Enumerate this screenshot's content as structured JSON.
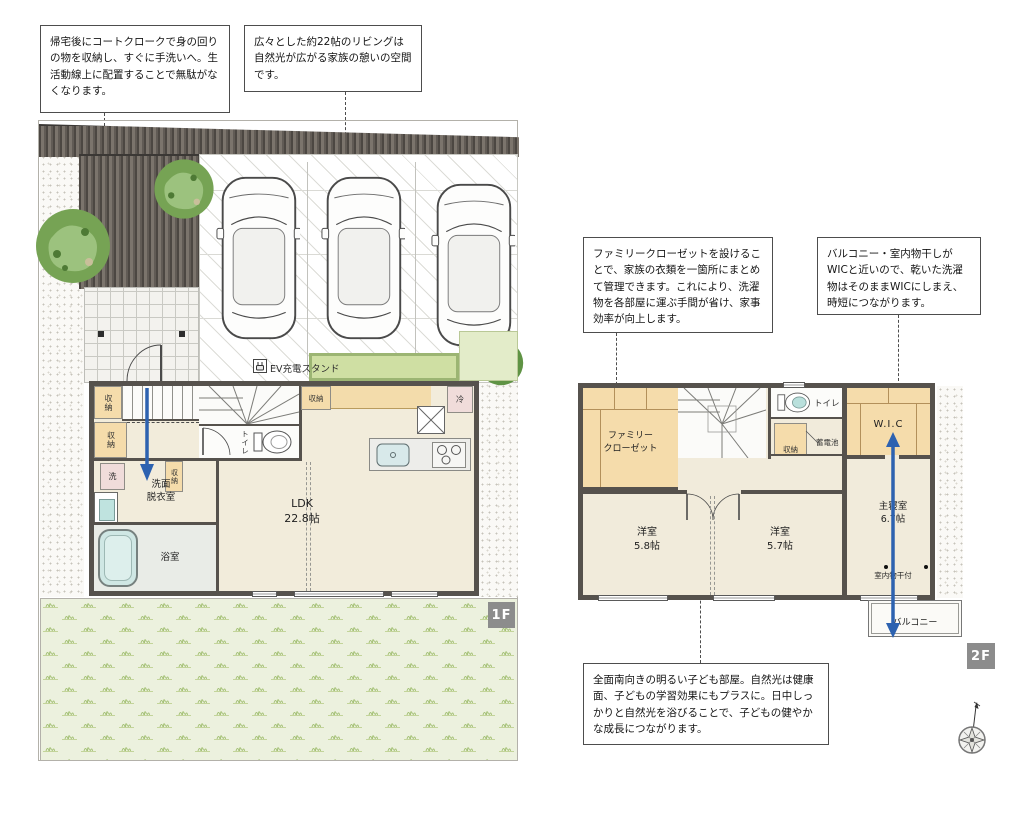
{
  "callouts": {
    "coat": "帰宅後にコートクロークで身の回りの物を収納し、すぐに手洗いへ。生活動線上に配置することで無駄がなくなります。",
    "living": "広々とした約22帖のリビングは自然光が広がる家族の憩いの空間です。",
    "family_closet": "ファミリークローゼットを設けることで、家族の衣類を一箇所にまとめて管理できます。これにより、洗濯物を各部屋に運ぶ手間が省け、家事効率が向上します。",
    "balcony_wic": "バルコニー・室内物干しがWICと近いので、乾いた洗濯物はそのままWICにしまえ、時短につながります。",
    "kids_room": "全面南向きの明るい子ども部屋。自然光は健康面、子どもの学習効果にもプラスに。日中しっかりと自然光を浴びることで、子どもの健やかな成長につながります。"
  },
  "floor1": {
    "badge": "1F",
    "ev_station": "EV充電スタンド",
    "labels": {
      "storage_a": "収納",
      "storage_b": "収納",
      "storage_c": "収納",
      "storage_kitchen": "収納",
      "toilet": "トイレ",
      "washer": "洗",
      "washroom": "洗面\n脱衣室",
      "bathroom": "浴室",
      "fridge": "冷",
      "ldk": "LDK\n22.8帖"
    }
  },
  "floor2": {
    "badge": "2F",
    "labels": {
      "family_closet": "ファミリー\nクローゼット",
      "toilet": "トイレ",
      "storage": "収納",
      "battery": "蓄電池",
      "wic": "W.I.C",
      "bedroom": "主寝室\n6.7帖",
      "room1": "洋室\n5.8帖",
      "room2": "洋室\n5.7帖",
      "drying": "室内物干付",
      "balcony": "バルコニー"
    }
  },
  "colors": {
    "wall": "#56524d",
    "tatami": "#f5dcab",
    "floor": "#f2ecdb",
    "arrow_blue": "#2d62b0",
    "lawn": "#ecf1de",
    "badge_bg": "#8c8c8c"
  }
}
